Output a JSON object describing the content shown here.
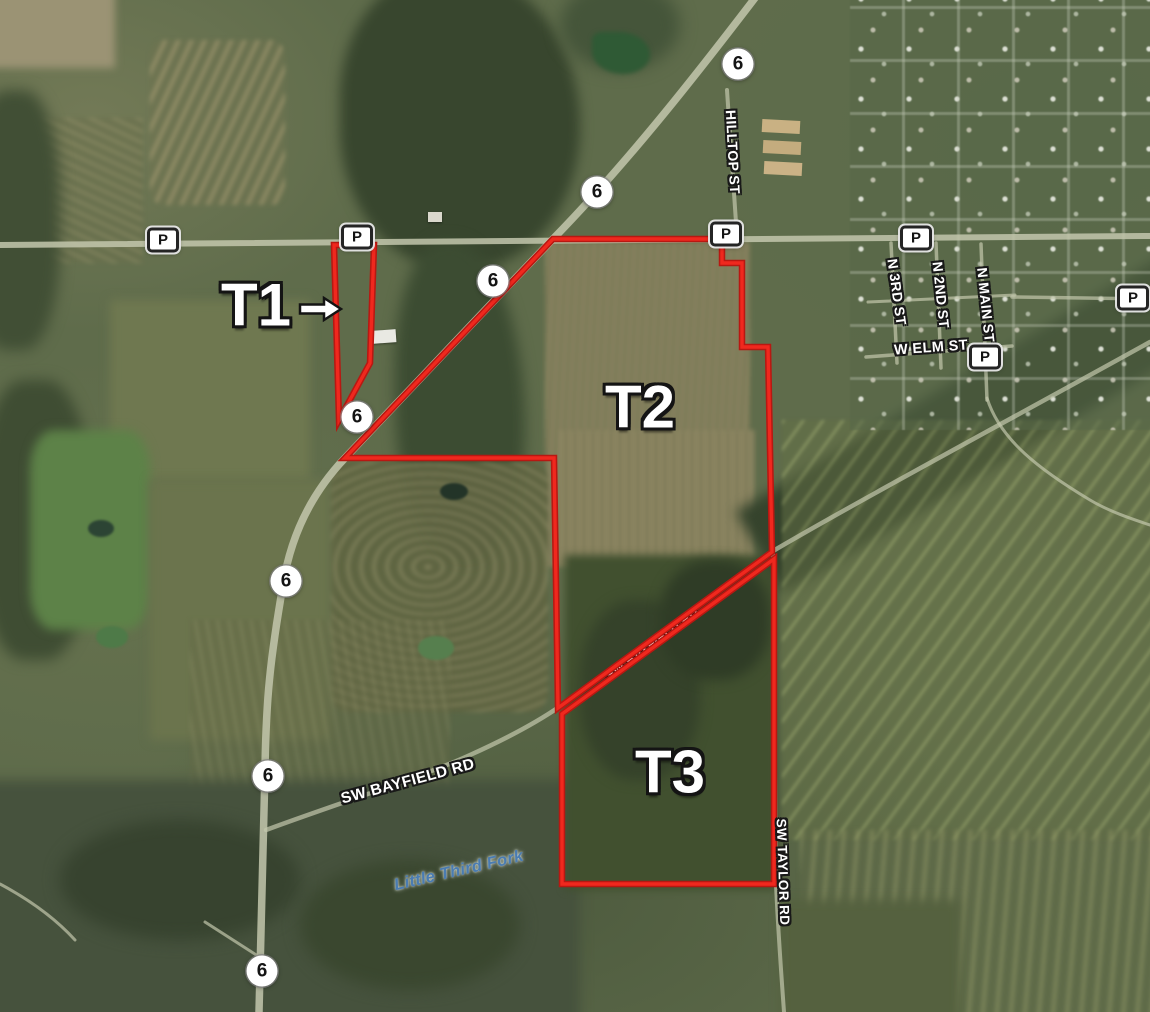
{
  "map": {
    "description": "Aerial tract map with three outlined tracts",
    "boundary_color": "#f0281e",
    "boundary_casing_color": "#b81812",
    "water_label_color": "#4a7cb2",
    "tracts": [
      {
        "id": "tract-t1",
        "label": "T1",
        "label_x": 256,
        "label_y": 305,
        "label_size": 60,
        "arrow": {
          "x1": 300,
          "y1": 309,
          "x2": 341,
          "y2": 309
        },
        "polygon": [
          [
            334,
            245
          ],
          [
            374,
            245
          ],
          [
            370,
            363
          ],
          [
            339,
            420
          ]
        ]
      },
      {
        "id": "tract-t2",
        "label": "T2",
        "label_x": 640,
        "label_y": 407,
        "label_size": 60,
        "polygon": [
          [
            553,
            239
          ],
          [
            722,
            239
          ],
          [
            722,
            263
          ],
          [
            742,
            263
          ],
          [
            742,
            347
          ],
          [
            768,
            347
          ],
          [
            772,
            552
          ],
          [
            558,
            708
          ],
          [
            554,
            458
          ],
          [
            345,
            458
          ]
        ]
      },
      {
        "id": "tract-t3",
        "label": "T3",
        "label_x": 670,
        "label_y": 772,
        "label_size": 60,
        "polygon": [
          [
            562,
            714
          ],
          [
            774,
            559
          ],
          [
            774,
            884
          ],
          [
            562,
            884
          ]
        ]
      }
    ],
    "road_labels": [
      {
        "id": "hilltop-st",
        "text": "HILLTOP ST",
        "x": 733,
        "y": 152,
        "rotate": 87,
        "size": 14,
        "type": "street"
      },
      {
        "id": "n-3rd-st",
        "text": "N 3RD ST",
        "x": 897,
        "y": 292,
        "rotate": 82,
        "size": 14,
        "type": "street"
      },
      {
        "id": "n-2nd-st",
        "text": "N 2ND ST",
        "x": 941,
        "y": 295,
        "rotate": 84,
        "size": 14,
        "type": "street"
      },
      {
        "id": "n-main-st",
        "text": "N MAIN ST",
        "x": 986,
        "y": 305,
        "rotate": 84,
        "size": 14,
        "type": "street"
      },
      {
        "id": "w-elm-st",
        "text": "W ELM ST",
        "x": 931,
        "y": 348,
        "rotate": -4,
        "size": 14.5,
        "type": "street"
      },
      {
        "id": "sw-bayfield-rd",
        "text": "SW BAYFIELD RD",
        "x": 408,
        "y": 782,
        "rotate": -15,
        "size": 15.5,
        "type": "street"
      },
      {
        "id": "sw-bayfield-rd-diagonal",
        "text": "SW BAYFIELD RD",
        "x": 652,
        "y": 644,
        "rotate": -36,
        "size": 12.5,
        "type": "street-under"
      },
      {
        "id": "sw-taylor-rd",
        "text": "SW TAYLOR RD",
        "x": 783,
        "y": 872,
        "rotate": 88,
        "size": 13.5,
        "type": "street"
      },
      {
        "id": "little-third-fork",
        "text": "Little Third Fork",
        "x": 459,
        "y": 871,
        "rotate": -13,
        "size": 16.5,
        "type": "water"
      }
    ],
    "route_shields": [
      {
        "type": "circle",
        "text": "6",
        "x": 738,
        "y": 64
      },
      {
        "type": "circle",
        "text": "6",
        "x": 597,
        "y": 192
      },
      {
        "type": "circle",
        "text": "6",
        "x": 493,
        "y": 281
      },
      {
        "type": "circle",
        "text": "6",
        "x": 357,
        "y": 417
      },
      {
        "type": "circle",
        "text": "6",
        "x": 286,
        "y": 581
      },
      {
        "type": "circle",
        "text": "6",
        "x": 268,
        "y": 776
      },
      {
        "type": "circle",
        "text": "6",
        "x": 262,
        "y": 971
      },
      {
        "type": "box",
        "text": "P",
        "x": 163,
        "y": 240
      },
      {
        "type": "box",
        "text": "P",
        "x": 357,
        "y": 237
      },
      {
        "type": "box",
        "text": "P",
        "x": 726,
        "y": 234
      },
      {
        "type": "box",
        "text": "P",
        "x": 916,
        "y": 238
      },
      {
        "type": "box",
        "text": "P",
        "x": 985,
        "y": 357
      },
      {
        "type": "box",
        "text": "P",
        "x": 1133,
        "y": 298
      }
    ]
  }
}
